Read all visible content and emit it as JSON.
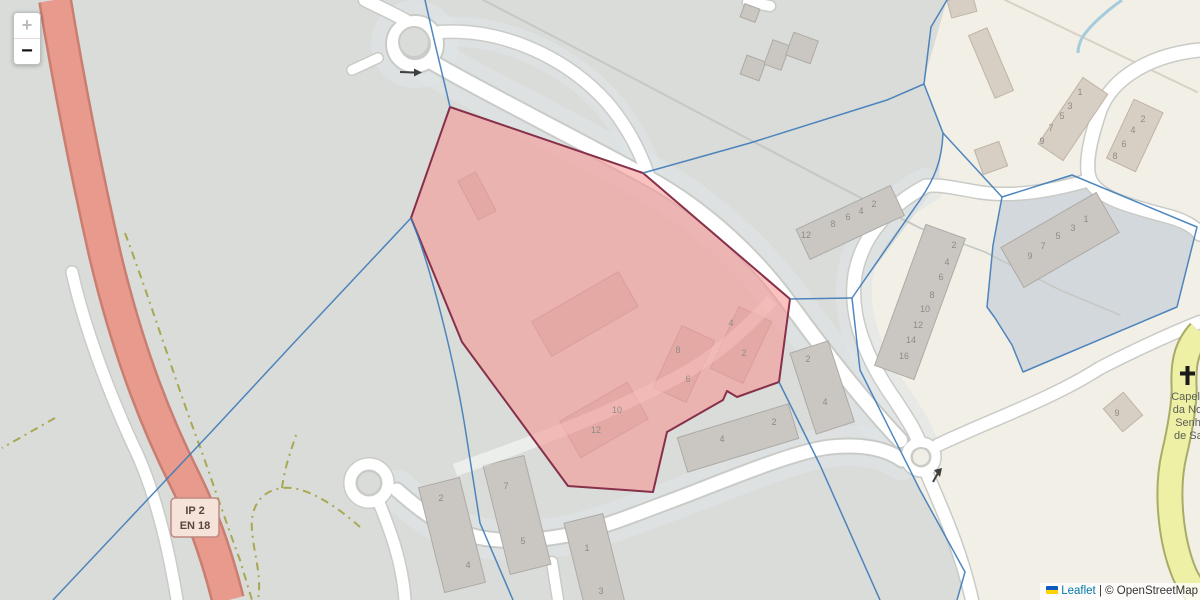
{
  "controls": {
    "zoom_in": "+",
    "zoom_out": "−"
  },
  "attribution": {
    "flag_icon": "ukraine-flag",
    "leaflet": "Leaflet",
    "separator": " | ",
    "copyright": "© OpenStreetMap"
  },
  "road_shield": {
    "line1": "IP 2",
    "line2": "EN 18"
  },
  "poi": {
    "icon": "christian-cross",
    "name_lines": [
      "Capelinha",
      "da Nossa",
      "Senhora",
      "de Santa"
    ]
  },
  "house_numbers": [
    {
      "t": "8",
      "x": 678,
      "y": 353
    },
    {
      "t": "6",
      "x": 688,
      "y": 382
    },
    {
      "t": "4",
      "x": 731,
      "y": 326
    },
    {
      "t": "2",
      "x": 744,
      "y": 356
    },
    {
      "t": "10",
      "x": 617,
      "y": 413
    },
    {
      "t": "12",
      "x": 596,
      "y": 433
    },
    {
      "t": "4",
      "x": 722,
      "y": 442
    },
    {
      "t": "2",
      "x": 774,
      "y": 425
    },
    {
      "t": "2",
      "x": 808,
      "y": 362
    },
    {
      "t": "4",
      "x": 825,
      "y": 405
    },
    {
      "t": "2",
      "x": 441,
      "y": 501
    },
    {
      "t": "4",
      "x": 468,
      "y": 568
    },
    {
      "t": "7",
      "x": 506,
      "y": 489
    },
    {
      "t": "5",
      "x": 523,
      "y": 544
    },
    {
      "t": "1",
      "x": 587,
      "y": 551
    },
    {
      "t": "3",
      "x": 601,
      "y": 594
    },
    {
      "t": "12",
      "x": 806,
      "y": 238
    },
    {
      "t": "8",
      "x": 833,
      "y": 227
    },
    {
      "t": "6",
      "x": 848,
      "y": 220
    },
    {
      "t": "4",
      "x": 861,
      "y": 214
    },
    {
      "t": "2",
      "x": 874,
      "y": 207
    },
    {
      "t": "2",
      "x": 954,
      "y": 248
    },
    {
      "t": "4",
      "x": 947,
      "y": 265
    },
    {
      "t": "6",
      "x": 941,
      "y": 280
    },
    {
      "t": "8",
      "x": 932,
      "y": 298
    },
    {
      "t": "10",
      "x": 925,
      "y": 312
    },
    {
      "t": "12",
      "x": 918,
      "y": 328
    },
    {
      "t": "14",
      "x": 911,
      "y": 343
    },
    {
      "t": "16",
      "x": 904,
      "y": 359
    },
    {
      "t": "9",
      "x": 1030,
      "y": 259
    },
    {
      "t": "7",
      "x": 1043,
      "y": 249
    },
    {
      "t": "5",
      "x": 1058,
      "y": 239
    },
    {
      "t": "3",
      "x": 1073,
      "y": 231
    },
    {
      "t": "1",
      "x": 1086,
      "y": 222
    },
    {
      "t": "9",
      "x": 1042,
      "y": 144
    },
    {
      "t": "7",
      "x": 1051,
      "y": 131
    },
    {
      "t": "5",
      "x": 1062,
      "y": 119
    },
    {
      "t": "3",
      "x": 1070,
      "y": 109
    },
    {
      "t": "1",
      "x": 1080,
      "y": 95
    },
    {
      "t": "8",
      "x": 1115,
      "y": 159
    },
    {
      "t": "6",
      "x": 1124,
      "y": 147
    },
    {
      "t": "4",
      "x": 1133,
      "y": 133
    },
    {
      "t": "2",
      "x": 1143,
      "y": 122
    },
    {
      "t": "9",
      "x": 1117,
      "y": 416
    }
  ],
  "colors": {
    "base_cream": "#f2efe7",
    "landuse_gray": "#d9dcd9",
    "boundary_region_fill": "#d2d8dc",
    "residential_band": "#dfe4e8",
    "road_white": "#ffffff",
    "road_casing": "#c9cbc7",
    "trunk_fill": "#e89a8c",
    "trunk_casing": "#c97e71",
    "yellow_road_fill": "#eef0a6",
    "yellow_road_casing": "#a8ac66",
    "track_dash": "#a8a851",
    "stream_blue": "#a6cbdc",
    "building_gray": "#cac6c2",
    "building_tan": "#d7cec4",
    "selection_fill": "rgba(246,151,149,0.6)",
    "selection_stroke": "#87304a",
    "admin_boundary": "#3d7ab8",
    "house_number_text": "#8e8b87",
    "shield_fill": "#f5e3da",
    "shield_border": "#c08a80",
    "leaflet_link": "#0078A8"
  }
}
